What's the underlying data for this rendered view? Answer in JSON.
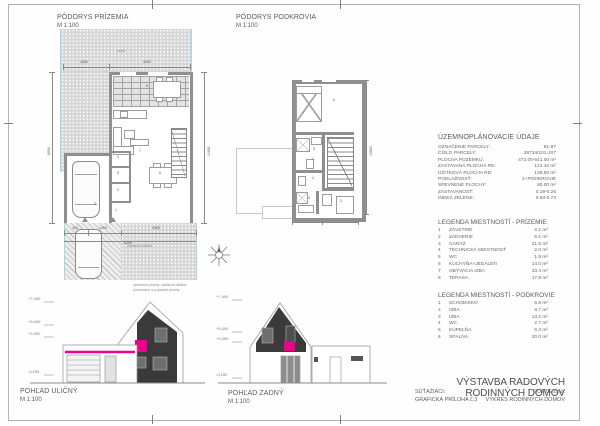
{
  "prizemie_plan": {
    "title": "PÔDORYS PRÍZEMIA",
    "scale": "M 1:100",
    "garden_label": "zeleň",
    "paving_label": "zámková dlažba",
    "note_line1": "spevnené plochy, zámková dlažba",
    "note_line2": "pochôdzne a pojazdné plochy",
    "room_numbers": [
      "1",
      "2",
      "3",
      "4",
      "5",
      "6",
      "7",
      "8"
    ],
    "dims": {
      "top": [
        "1800",
        "4400"
      ],
      "bottom": [
        "420",
        "1400",
        "4400"
      ],
      "bottom_total": "6200",
      "left": "8000",
      "right": "11600"
    }
  },
  "podkrovie_plan": {
    "title": "PÔDORYS PODKROVIA",
    "scale": "M 1:100",
    "room_numbers": [
      "1",
      "2",
      "3",
      "4",
      "5",
      "6"
    ],
    "dim_right": "10800"
  },
  "urban_data": {
    "title": "ÚZEMNOPLÁNOVACIE ÚDAJE",
    "rows": [
      {
        "label": "OZNAČENIE PARCELY:",
        "value": "81-87"
      },
      {
        "label": "ČÍSLO PARCELY:",
        "value": "28734/101-107"
      },
      {
        "label": "PLOCHA POZEMKU:",
        "value": "472.00-641.00 m²"
      },
      {
        "label": "ZASTAVANÁ PLOCHA RD:",
        "value": "122.10 m²"
      },
      {
        "label": "ÚŽITKOVÁ PLOCHA RD:",
        "value": "139.50 m²"
      },
      {
        "label": "PODLAŽNOSŤ:",
        "value": "1+PODKROVIE"
      },
      {
        "label": "SPEVNENÉ PLOCHY:",
        "value": "80.00 m²"
      },
      {
        "label": "ZASTAVANOSŤ:",
        "value": "0.19-0.26"
      },
      {
        "label": "INDEX ZELENE:",
        "value": "0.63-0.73"
      }
    ]
  },
  "legend_prizemie": {
    "title": "LEGENDA MIESTNOSTÍ - PRÍZEMIE",
    "rows": [
      {
        "no": "1",
        "name": "ZÁVETRIE",
        "area": "2.1 m²"
      },
      {
        "no": "2",
        "name": "ZÁDVERIE",
        "area": "5.1 m²"
      },
      {
        "no": "3",
        "name": "GARÁŽ",
        "area": "21.6 m²"
      },
      {
        "no": "4",
        "name": "TECHNICKÁ MIESTNOSŤ",
        "area": "2.0 m²"
      },
      {
        "no": "5",
        "name": "WC",
        "area": "1.9 m²"
      },
      {
        "no": "6",
        "name": "KUCHYŇA+JEDÁLEŇ",
        "area": "14.0 m²"
      },
      {
        "no": "7",
        "name": "OBÝVACIA IZBA",
        "area": "33.4 m²"
      },
      {
        "no": "8",
        "name": "TERASA",
        "area": "17.8 m²"
      }
    ]
  },
  "legend_podkrovie": {
    "title": "LEGENDA MIESTNOSTÍ - PODKROVIE",
    "rows": [
      {
        "no": "1",
        "name": "SCHODISKO",
        "area": "6.5 m²"
      },
      {
        "no": "2",
        "name": "IZBA",
        "area": "9.7 m²"
      },
      {
        "no": "3",
        "name": "IZBA",
        "area": "13.2 m²"
      },
      {
        "no": "4",
        "name": "WC",
        "area": "2.7 m²"
      },
      {
        "no": "5",
        "name": "KÚPEĽŇA",
        "area": "6.3 m²"
      },
      {
        "no": "6",
        "name": "SPÁLŇA",
        "area": "20.0 m²"
      }
    ]
  },
  "elevation_street": {
    "label": "POHĽAD ULIČNÝ",
    "scale": "M 1:100",
    "marks": [
      "+7,400",
      "+5,400",
      "+3,450",
      "-0,150"
    ]
  },
  "elevation_rear": {
    "label": "POHĽAD ZADNÝ",
    "scale": "M 1:100",
    "marks": [
      "+7,400",
      "+5,400",
      "+3,450",
      "-0,150"
    ]
  },
  "title_block": {
    "title": "VÝSTAVBA RADOVÝCH RODINNÝCH DOMOV",
    "row1_left": "SÚŤAŽIACI:",
    "row1_right": "GUTTE s.r.o.",
    "row2_left": "GRAFICKÁ PRÍLOHA č.3",
    "row2_right": "VÝKRES RODINNÝCH DOMOV"
  },
  "colors": {
    "accent_magenta": "#ec008c",
    "parcel_cyan": "#a4d8e8",
    "facade_dark": "#3a3a3a"
  }
}
